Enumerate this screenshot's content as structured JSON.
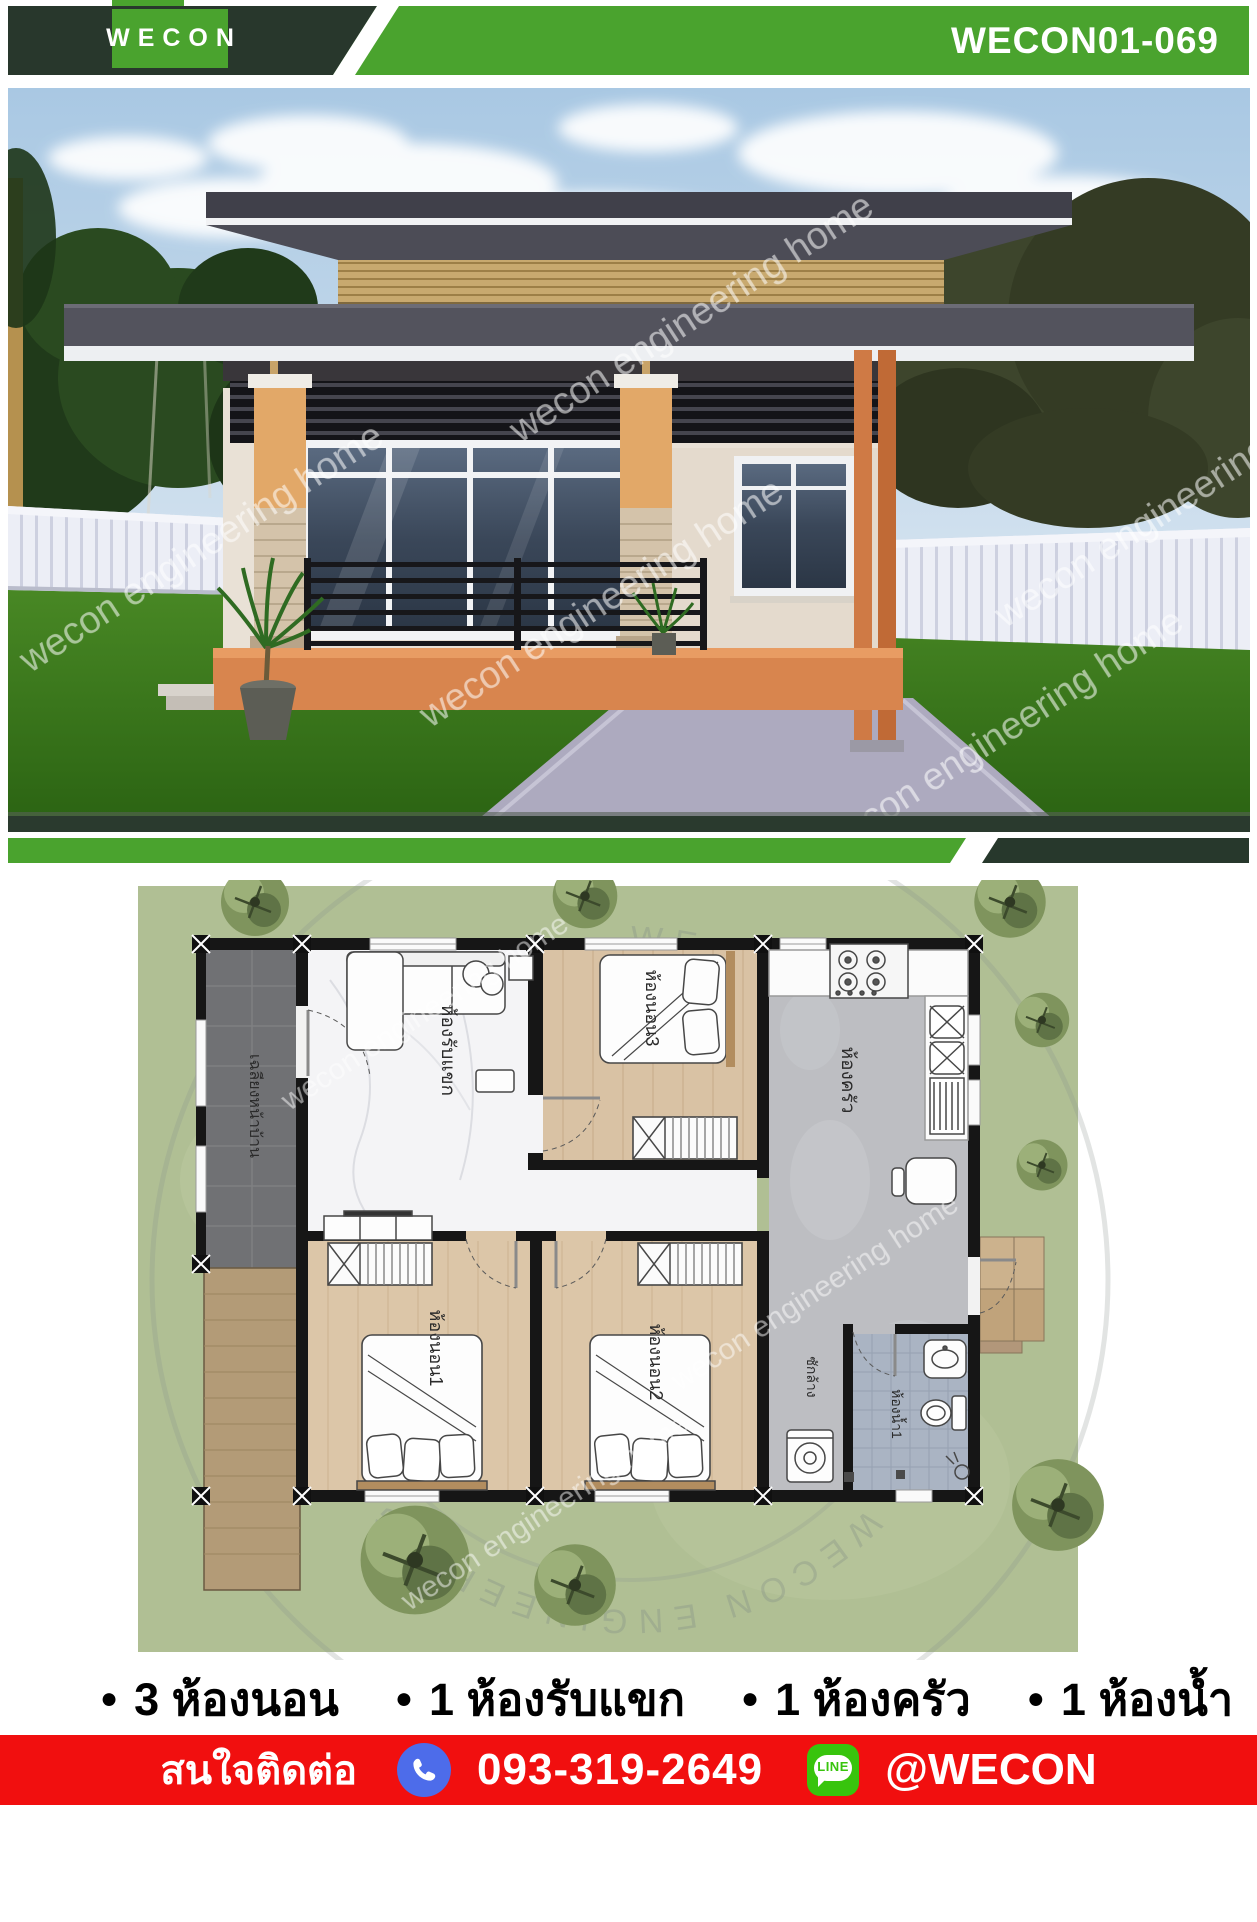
{
  "header": {
    "logo_text": "WECON",
    "code": "WECON01-069"
  },
  "hero": {
    "watermark": "wecon engineering home"
  },
  "plan": {
    "rooms": {
      "porch": "เฉลียงหน้าบ้าน",
      "living": "ห้องรับแขก",
      "bedroom3": "ห้องนอน3",
      "kitchen": "ห้องครัว",
      "bedroom1": "ห้องนอน1",
      "bedroom2": "ห้องนอน2",
      "laundry": "ซักล้าง",
      "bathroom": "ห้องน้ำ1"
    },
    "stamp_text": "WECON ENGINEERING HOME • WECON ENGINEERING HOME •"
  },
  "features": {
    "items": [
      {
        "icon": "●",
        "label": "3 ห้องนอน"
      },
      {
        "icon": "●",
        "label": "1 ห้องรับแขก"
      },
      {
        "icon": "●",
        "label": "1 ห้องครัว"
      },
      {
        "icon": "●",
        "label": "1 ห้องน้ำ"
      }
    ]
  },
  "footer": {
    "contact_label": "สนใจติดต่อ",
    "phone": "093-319-2649",
    "line_badge": "LINE",
    "line_id": "@WECON"
  },
  "colors": {
    "brand_green": "#4aa32e",
    "brand_dark_green": "#28372c",
    "footer_red": "#f10f0f",
    "phone_blue": "#4d6cea",
    "line_green": "#38c40d"
  }
}
